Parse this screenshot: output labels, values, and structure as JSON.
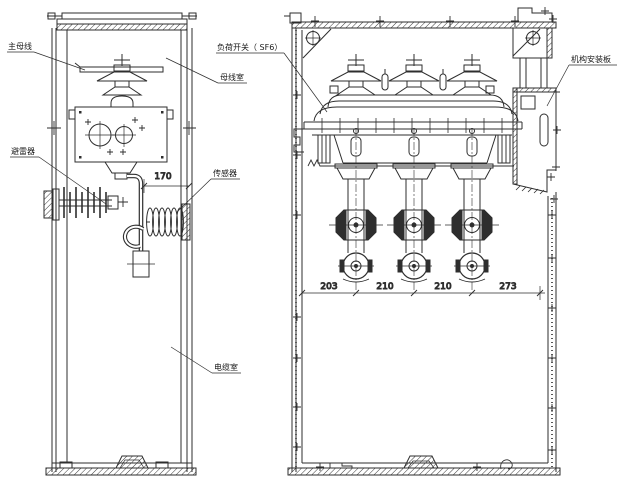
{
  "diagram": {
    "labels": {
      "main_busbar": "主母线",
      "load_switch_sf6": "负荷开关（ SF6）",
      "busbar_compartment": "母线室",
      "surge_arrester": "避雷器",
      "sensor": "传感器",
      "cable_compartment": "电缆室",
      "mechanism_mounting_plate": "机构安装板"
    },
    "dimensions": {
      "sensor_offset": "170",
      "bushing_spacing": [
        "203",
        "210",
        "210",
        "273"
      ]
    },
    "colors": {
      "line": "#2e2e2e",
      "background": "#ffffff"
    }
  }
}
